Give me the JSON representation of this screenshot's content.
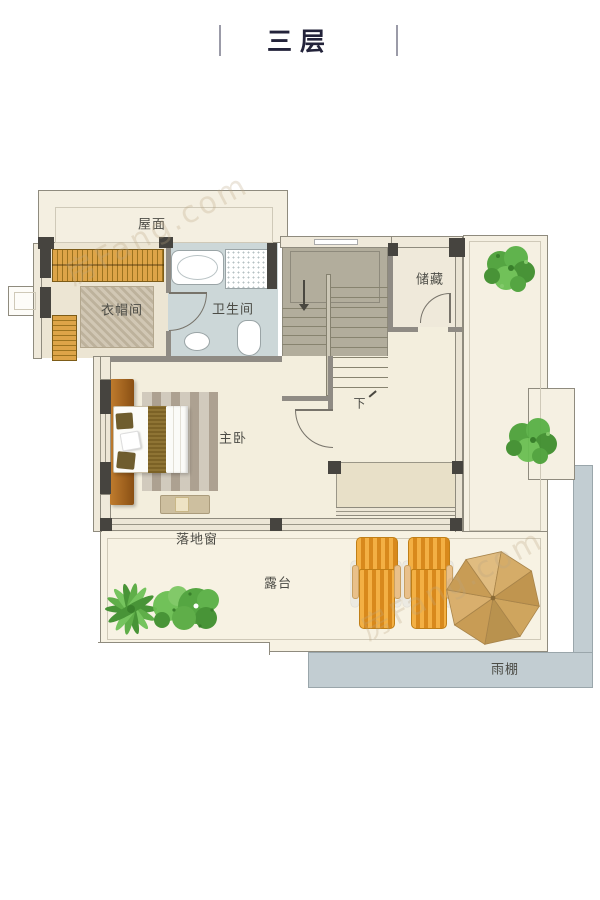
{
  "title": {
    "text": "三层"
  },
  "watermark": {
    "text": "房Fang.com"
  },
  "labels": {
    "roof": "屋面",
    "cloakroom": "衣帽间",
    "bathroom": "卫生间",
    "storage": "储藏",
    "stairs_down": "下",
    "master_bedroom": "主卧",
    "floor_window": "落地窗",
    "terrace": "露台",
    "canopy": "雨棚"
  },
  "colors": {
    "title_text": "#23233a",
    "label_text": "#4c4c46",
    "wall_dark": "#46443f",
    "outline": "#8f8b7e",
    "floor_cream": "#f3eedd",
    "roof_cream": "#f4efe1",
    "bathroom_blue": "#ccd7d8",
    "stair_gray": "#b2ad9c",
    "bay_beige": "#e8e0c8",
    "wood_brown": "#a96a25",
    "wardrobe_orange": "#dda448",
    "lounge_orange": "#f0a93c",
    "umbrella_tan": "#d9af6d",
    "canopy_blue": "#c2cdd2",
    "plant_green": "#4f9e3c"
  }
}
